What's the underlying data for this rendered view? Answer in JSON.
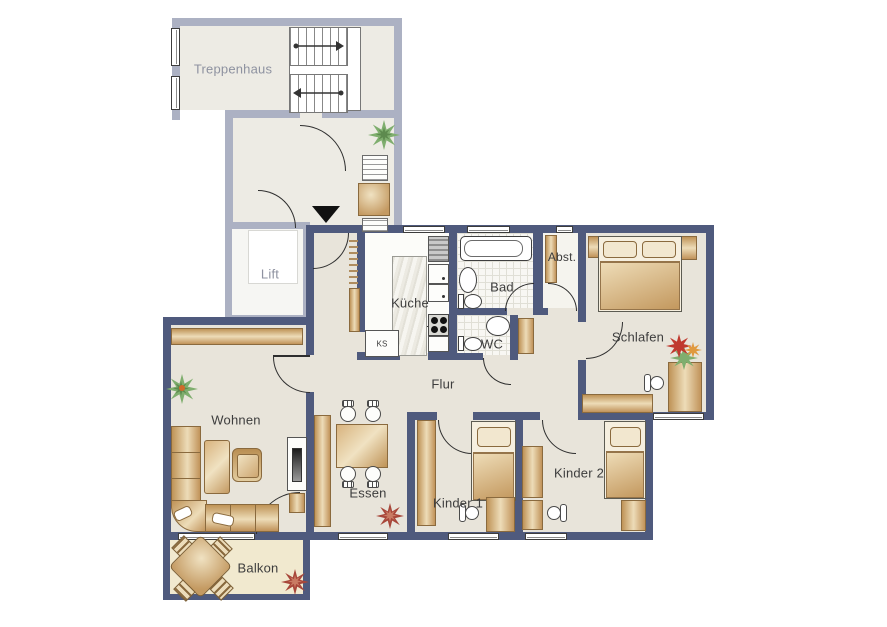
{
  "plan": {
    "kind": "apartment-floor-plan",
    "language": "de"
  },
  "rooms": {
    "treppenhaus": {
      "label": "Treppenhaus"
    },
    "lift": {
      "label": "Lift"
    },
    "kueche": {
      "label": "Küche"
    },
    "ks": {
      "label": "KS"
    },
    "bad": {
      "label": "Bad"
    },
    "wc": {
      "label": "WC"
    },
    "abstellraum": {
      "label": "Abst."
    },
    "schlafen": {
      "label": "Schlafen"
    },
    "flur": {
      "label": "Flur"
    },
    "wohnen": {
      "label": "Wohnen"
    },
    "essen": {
      "label": "Essen"
    },
    "kinder1": {
      "label": "Kinder 1"
    },
    "kinder2": {
      "label": "Kinder 2"
    },
    "balkon": {
      "label": "Balkon"
    }
  },
  "colors": {
    "apartment_wall": "#4f5a7d",
    "common_wall": "#acb1c3",
    "floor": "#e8e4da",
    "common_floor": "#edebe4",
    "balcony_floor": "#f1e9cf",
    "furniture": "#c49a62",
    "plant_green": "#7fae6e",
    "accent_red": "#a8473a",
    "entrance_marker": "#111111"
  },
  "symbols": [
    "staircase",
    "stair-direction-arrows",
    "elevator",
    "entrance-arrow",
    "hall-table",
    "double-bed",
    "single-bed",
    "wardrobe",
    "sideboard",
    "desk",
    "desk-chair",
    "sofa",
    "coffee-table",
    "armchair",
    "tv-board",
    "dining-table",
    "dining-chair",
    "balcony-table",
    "balcony-chair",
    "bathtub",
    "washbasin",
    "toilet",
    "kitchen-counter",
    "kitchen-sink",
    "stove",
    "refrigerator",
    "radiator",
    "plant",
    "flower",
    "starburst"
  ]
}
